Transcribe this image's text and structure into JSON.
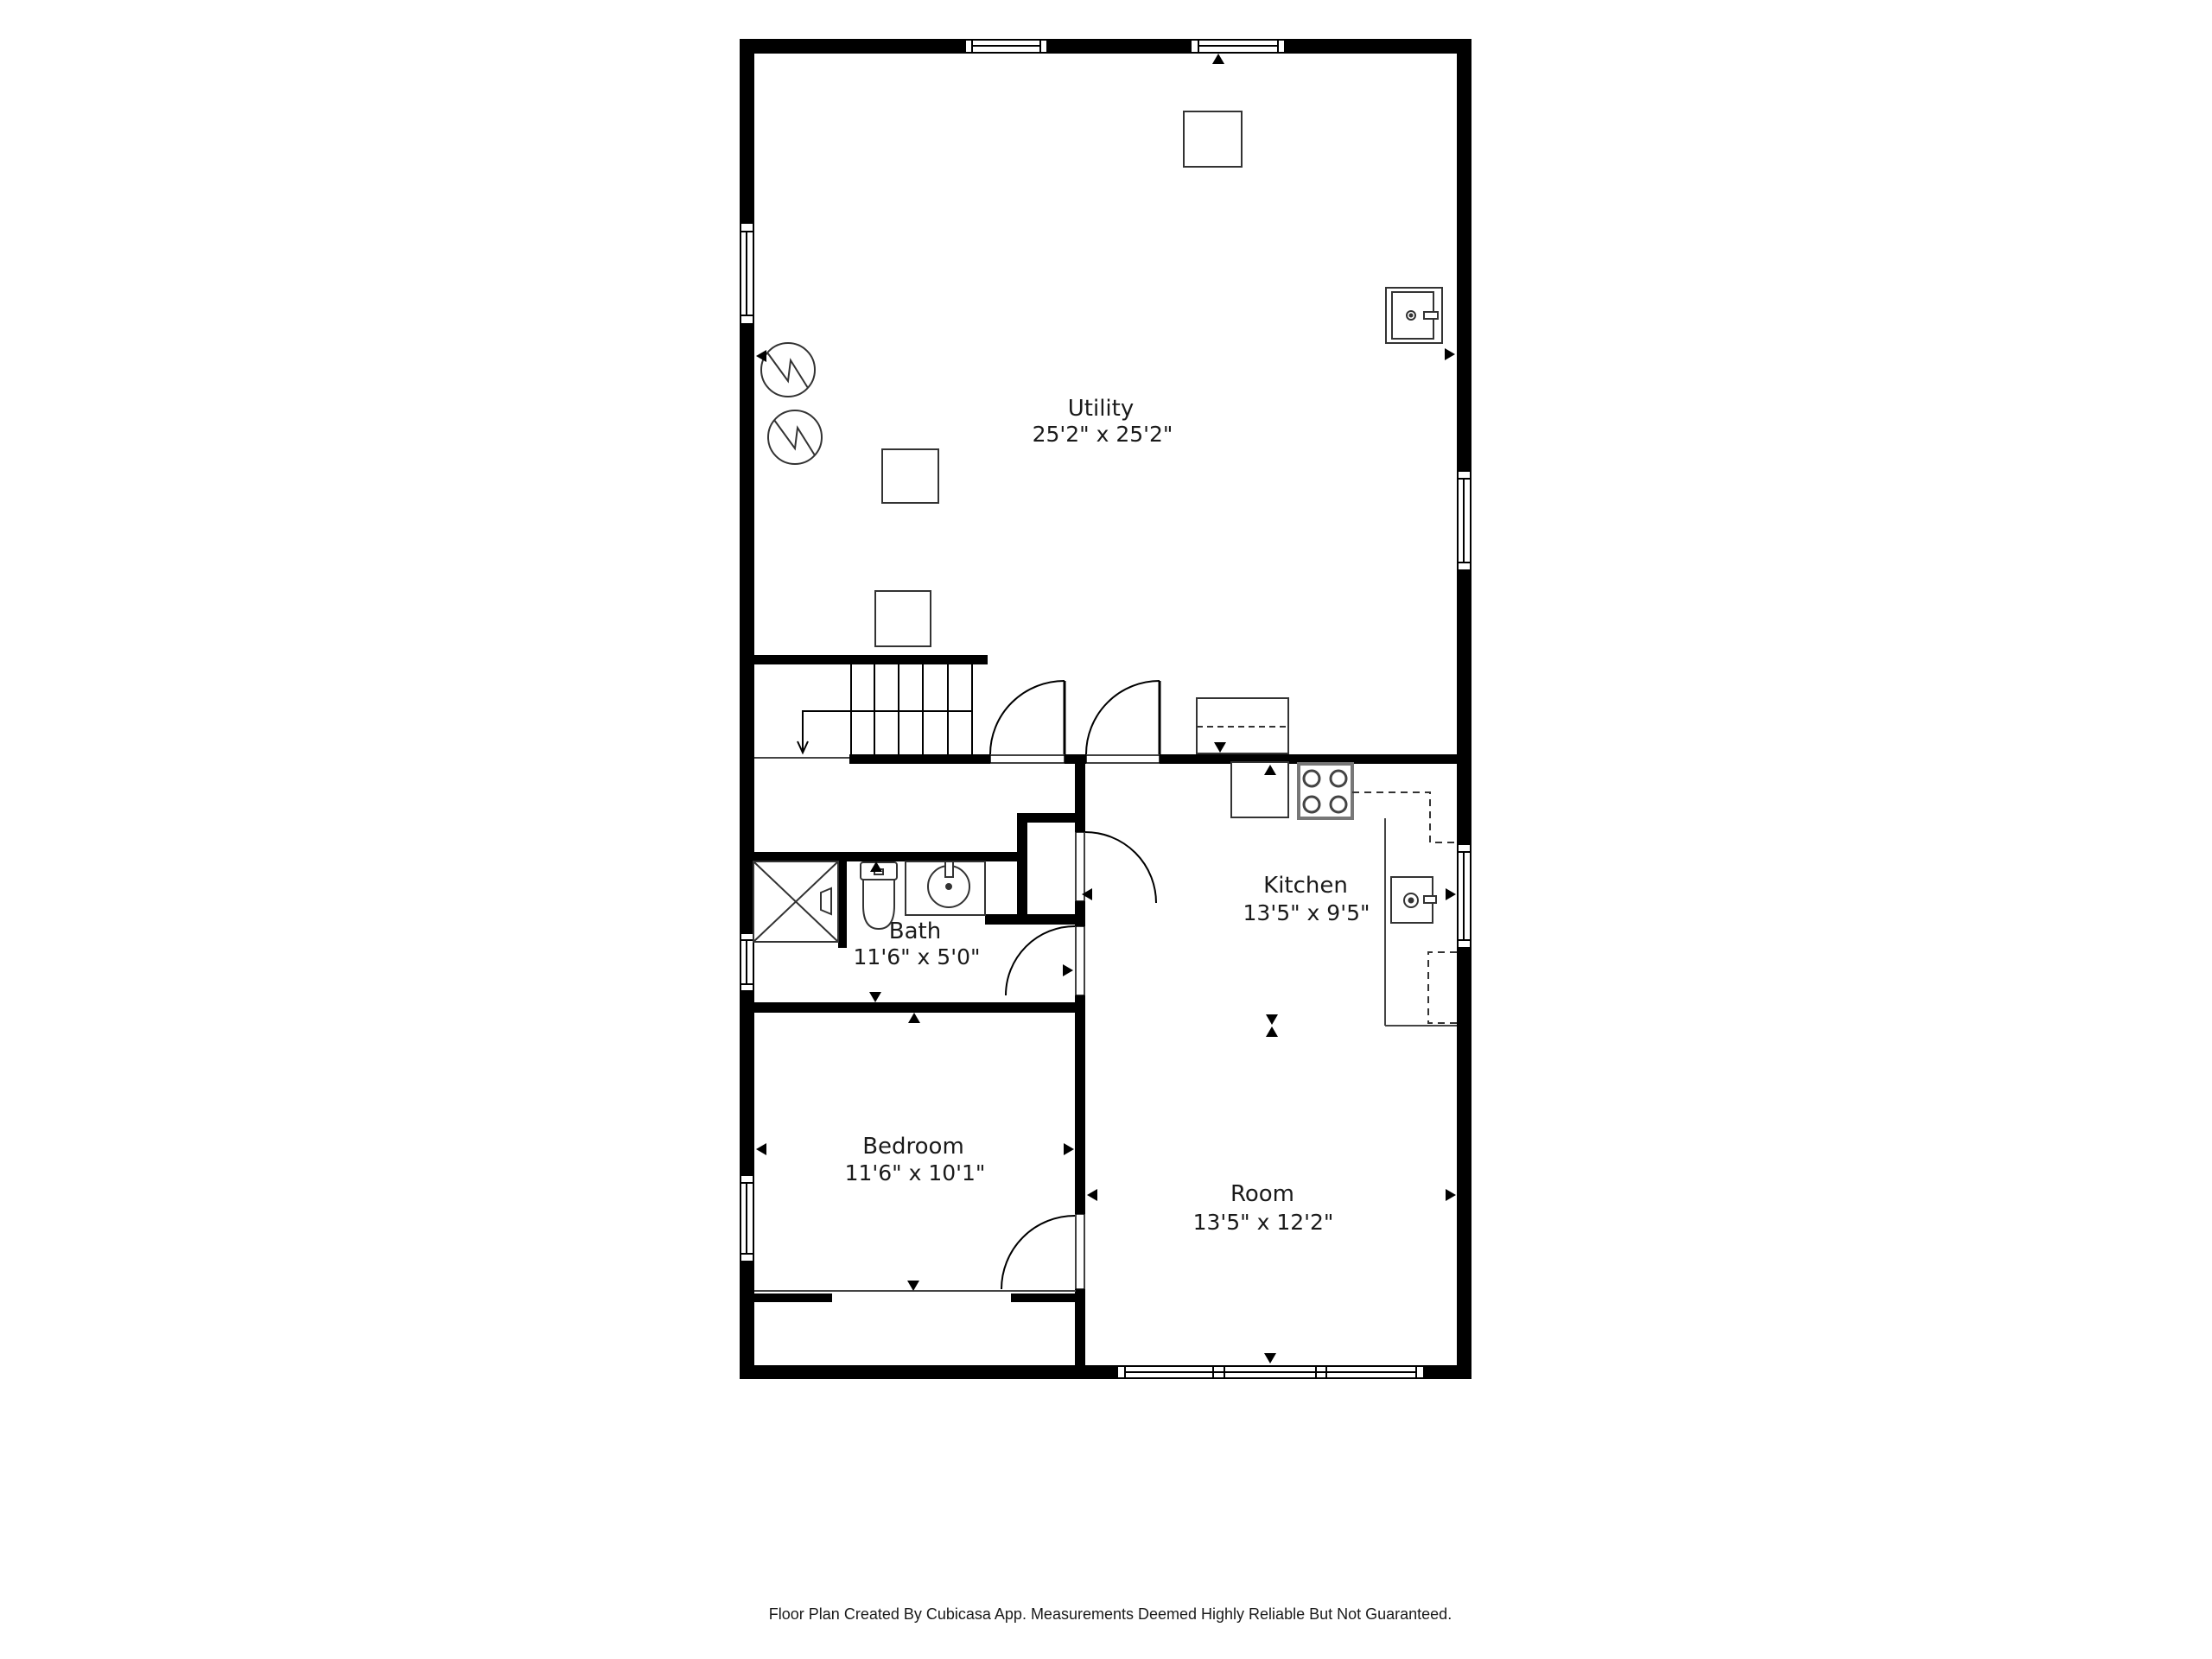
{
  "plan": {
    "rooms": [
      {
        "name": "Utility",
        "dimensions": "25'2\" x 25'2\""
      },
      {
        "name": "Kitchen",
        "dimensions": "13'5\" x 9'5\""
      },
      {
        "name": "Bath",
        "dimensions": "11'6\" x 5'0\""
      },
      {
        "name": "Bedroom",
        "dimensions": "11'6\" x 10'1\""
      },
      {
        "name": "Room",
        "dimensions": "13'5\" x 12'2\""
      }
    ],
    "fixtures": [
      "water-heater-icon",
      "water-heater-icon",
      "washer-icon",
      "storage-box-icon",
      "storage-box-icon",
      "cabinet-icon",
      "counter-dashed-icon",
      "refrigerator-icon",
      "stove-icon",
      "dishwasher-icon",
      "shower-icon",
      "toilet-icon",
      "bathroom-sink-icon",
      "stairs-icon"
    ],
    "colors": {
      "background": "#ffffff",
      "walls": "#000000",
      "text": "#1a1a1a",
      "fixture_stroke": "#333333",
      "stove_stroke": "#777777"
    }
  },
  "footer": {
    "text": "Floor Plan Created By Cubicasa App. Measurements Deemed Highly Reliable But Not Guaranteed."
  }
}
